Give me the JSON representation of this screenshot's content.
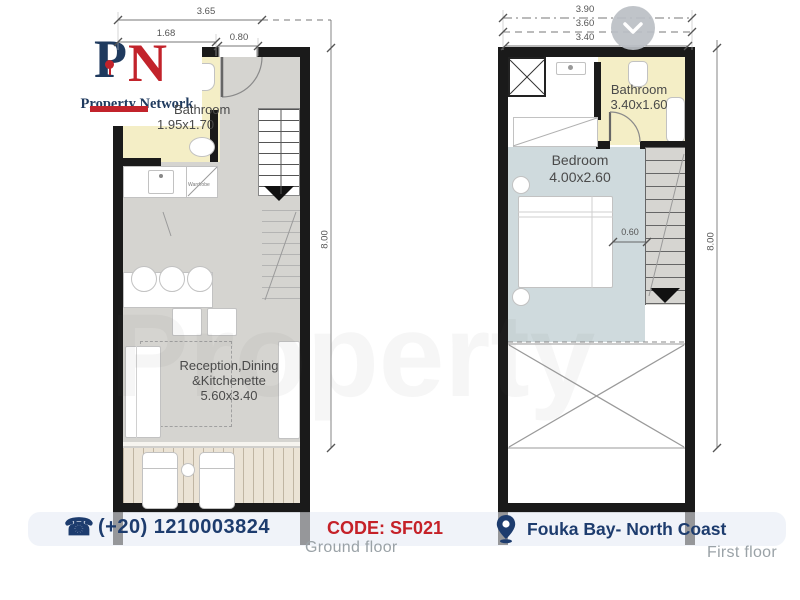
{
  "watermark_text": "Property",
  "logo": {
    "letter_p": "P",
    "letter_n": "N",
    "name": "Property Network"
  },
  "icons": {
    "phone_glyph": "☎"
  },
  "ground_floor": {
    "caption": "Ground floor",
    "dimensions": {
      "width_total": "3.65",
      "width_left": "1.68",
      "door_width": "0.80",
      "depth_total": "8.00"
    },
    "bathroom": {
      "name": "Bathroom",
      "size": "1.95x1.70"
    },
    "wardrobe_label": "Wardrobe",
    "reception": {
      "line1": "Reception,Dining",
      "line2": "&Kitchenette",
      "size": "5.60x3.40"
    }
  },
  "first_floor": {
    "caption": "First floor",
    "dimensions": {
      "width_total": "3.90",
      "width_mid": "3.60",
      "width_inner": "3.40",
      "depth_total": "8.00",
      "bed_clearance": "0.60"
    },
    "bathroom": {
      "name": "Bathroom",
      "size": "3.40x1.60"
    },
    "bedroom": {
      "name": "Bedroom",
      "size": "4.00x2.60"
    }
  },
  "footer": {
    "phone": "(+20) 1210003824",
    "code": "CODE: SF021",
    "location": "Fouka Bay- North Coast"
  },
  "colors": {
    "navy": "#1d3c6e",
    "red": "#c52128",
    "bathroom_fill": "#f4eec6",
    "bedroom_fill": "#cfdadd",
    "floor_fill": "#d5d4d0",
    "terrace_fill": "#ebe3d5",
    "caption_gray": "#9aa2a7"
  }
}
